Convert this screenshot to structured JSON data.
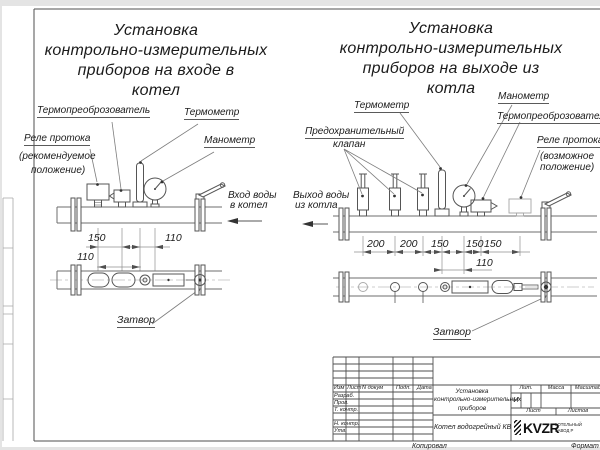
{
  "sheet": {
    "titles": {
      "left": [
        "Установка",
        "контрольно-измерительных",
        "приборов на входе в",
        "котел"
      ],
      "right": [
        "Установка",
        "контрольно-измерительных",
        "приборов на выходе из",
        "котла"
      ]
    },
    "left_figure": {
      "thermo_converter": "Термопреоброзователь",
      "thermometer": "Термометр",
      "flow_relay": "Реле протока",
      "flow_relay_note1": "(рекомендуемое",
      "flow_relay_note2": "положение)",
      "manometer": "Манометр",
      "flow_caption1": "Вход воды",
      "flow_caption2": "в котел",
      "valve": "Затвор",
      "dims": [
        "150",
        "110",
        "110"
      ]
    },
    "right_figure": {
      "thermometer": "Термометр",
      "manometer": "Манометр",
      "thermo_converter": "Термопреоброзователь",
      "safety_valve1": "Предохранительный",
      "safety_valve2": "клапан",
      "flow_relay": "Реле протока",
      "flow_relay_note1": "(возможное",
      "flow_relay_note2": "положение)",
      "flow_caption1": "Выход воды",
      "flow_caption2": "из котла",
      "valve": "Затвор",
      "dims": [
        "200",
        "200",
        "150",
        "150",
        "150",
        "110"
      ]
    },
    "title_block": {
      "rev_cols": [
        "Изм",
        "Лист",
        "N докум",
        "Подп.",
        "Дата"
      ],
      "roles": [
        "Разраб.",
        "Пров.",
        "Т. контр.",
        "Н. контр.",
        "Утв."
      ],
      "doc_title": [
        "Установка",
        "контрольно-измерительных",
        "приборов"
      ],
      "product": "Котел водогрейный КВ",
      "lit_label": "Лит.",
      "lit_value": "И",
      "mass_label": "Масса",
      "scale_label": "Масштаб",
      "sheet_label": "Лист",
      "sheets_label": "Листов",
      "logo": "KVZR",
      "logo_line1": "КОТЕЛЬНЫЙ",
      "logo_line2": "ЗАВОД Р",
      "copied": "Копировал",
      "format": "Формат"
    }
  }
}
